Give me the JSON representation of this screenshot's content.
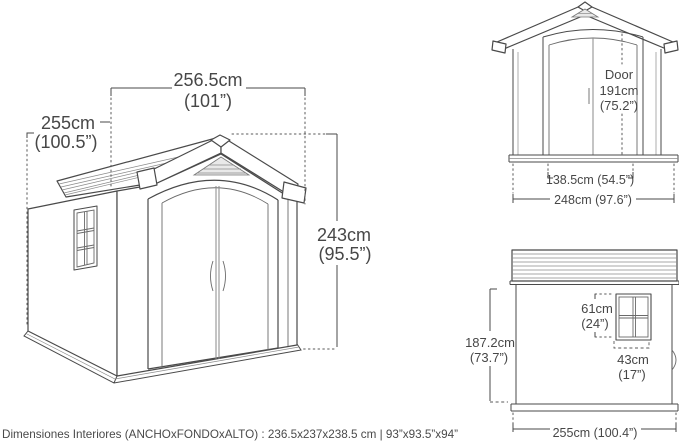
{
  "accent_colors": {
    "line": "#4a4a4a",
    "text": "#474747",
    "vent_fill": "#e9e9e9"
  },
  "perspective_view": {
    "width_cm": "256.5cm",
    "width_in": "(101”)",
    "depth_cm": "255cm",
    "depth_in": "(100.5”)",
    "height_cm": "243cm",
    "height_in": "(95.5”)"
  },
  "front_view": {
    "door_title": "Door",
    "door_height_cm": "191cm",
    "door_height_in": "(75.2”)",
    "door_width": "138.5cm (54.5”)",
    "overall_width": "248cm (97.6”)"
  },
  "side_view": {
    "window_height_cm": "61cm",
    "window_height_in": "(24”)",
    "window_width_cm": "43cm",
    "window_width_in": "(17”)",
    "wall_height_cm": "187.2cm",
    "wall_height_in": "(73.7”)",
    "overall_depth": "255cm (100.4”)"
  },
  "footer": {
    "interior_dimensions": "Dimensiones Interiores (ANCHOxFONDOxALTO) : 236.5x237x238.5 cm | 93”x93.5”x94”"
  }
}
